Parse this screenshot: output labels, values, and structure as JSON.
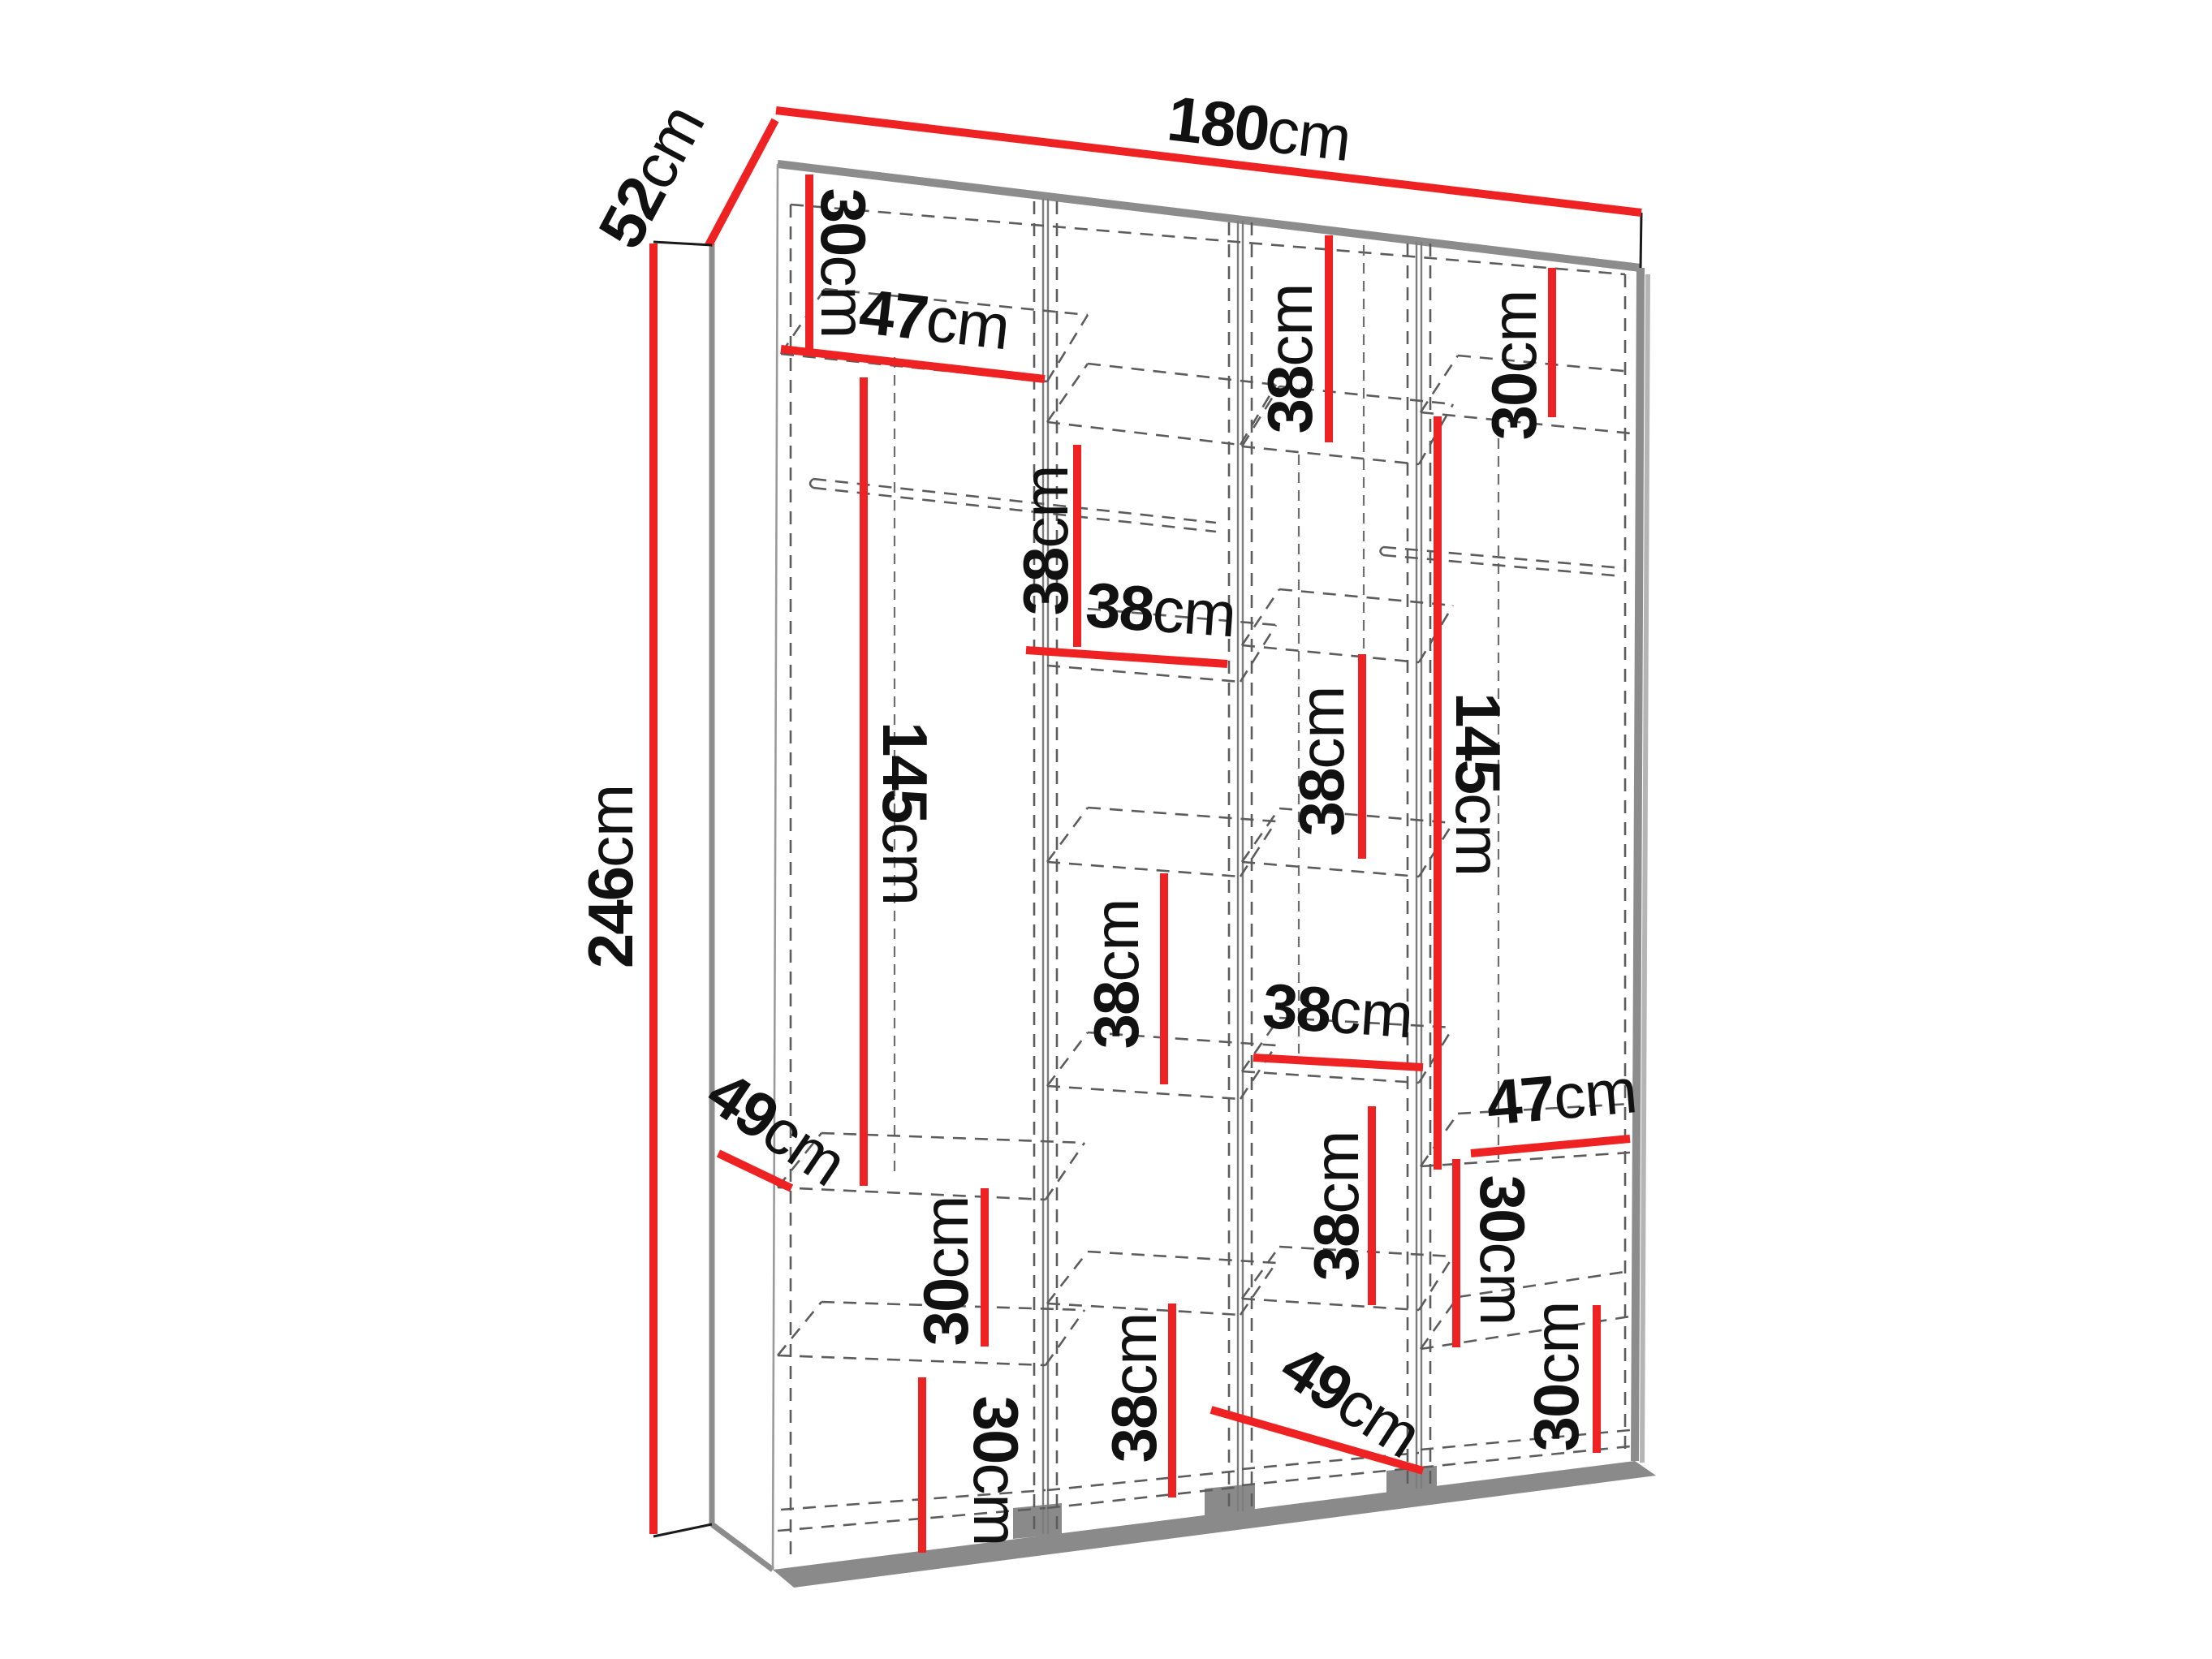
{
  "diagram": {
    "type": "furniture-dimension-diagram",
    "subject": "four-door wardrobe interior layout, perspective view with dashed shelf outlines",
    "unit": "cm",
    "overall": {
      "width": "180cm",
      "depth": "52cm",
      "height": "246cm"
    },
    "colors": {
      "dimension_red": "#ee2222",
      "outline_gray": "#8c8c8c",
      "dashed_gray": "#5c5c5c",
      "text": "#111111",
      "background": "#ffffff"
    },
    "labels": [
      {
        "name": "depth-top",
        "value": "52",
        "unit": "cm"
      },
      {
        "name": "width-top",
        "value": "180",
        "unit": "cm"
      },
      {
        "name": "height-left",
        "value": "246",
        "unit": "cm"
      },
      {
        "name": "col1-top-height",
        "value": "30",
        "unit": "cm"
      },
      {
        "name": "col1-width",
        "value": "47",
        "unit": "cm"
      },
      {
        "name": "col1-hanging-height",
        "value": "145",
        "unit": "cm"
      },
      {
        "name": "col1-shelf-depth",
        "value": "49",
        "unit": "cm"
      },
      {
        "name": "col1-mid-height",
        "value": "30",
        "unit": "cm"
      },
      {
        "name": "col1-bottom-height",
        "value": "30",
        "unit": "cm"
      },
      {
        "name": "col2-top-height",
        "value": "38",
        "unit": "cm"
      },
      {
        "name": "col2-width",
        "value": "38",
        "unit": "cm"
      },
      {
        "name": "col2-mid-height",
        "value": "38",
        "unit": "cm"
      },
      {
        "name": "col2-bottom-height",
        "value": "38",
        "unit": "cm"
      },
      {
        "name": "col3-top-height",
        "value": "38",
        "unit": "cm"
      },
      {
        "name": "col3-upper-height",
        "value": "38",
        "unit": "cm"
      },
      {
        "name": "col3-width",
        "value": "38",
        "unit": "cm"
      },
      {
        "name": "col3-lower-height",
        "value": "38",
        "unit": "cm"
      },
      {
        "name": "col3-shelf-depth",
        "value": "49",
        "unit": "cm"
      },
      {
        "name": "col4-top-height",
        "value": "30",
        "unit": "cm"
      },
      {
        "name": "col4-hanging-height",
        "value": "145",
        "unit": "cm"
      },
      {
        "name": "col4-width",
        "value": "47",
        "unit": "cm"
      },
      {
        "name": "col4-mid-height",
        "value": "30",
        "unit": "cm"
      },
      {
        "name": "col4-bottom-height",
        "value": "30",
        "unit": "cm"
      }
    ]
  }
}
